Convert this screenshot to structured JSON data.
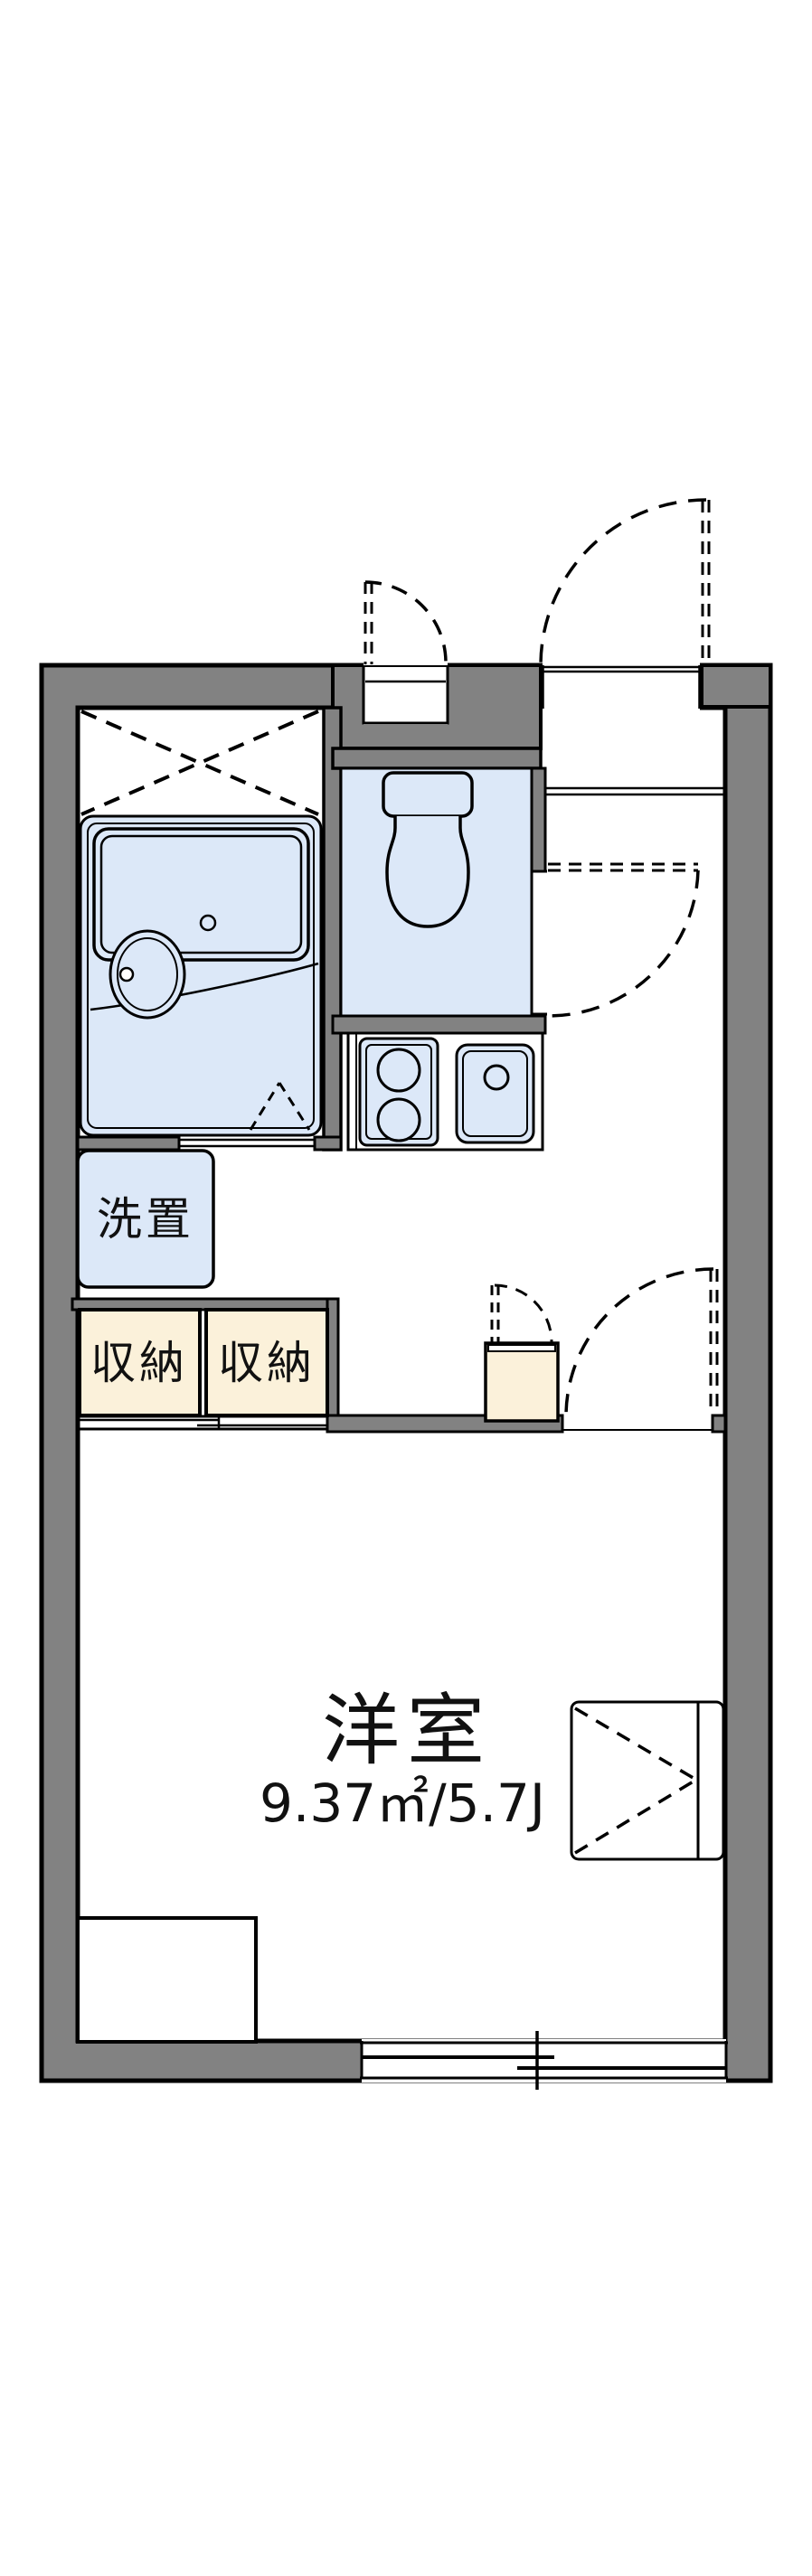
{
  "plan": {
    "type": "apartment-floorplan",
    "labels": {
      "washer_space": "洗置",
      "storage_left": "収納",
      "storage_right": "収納",
      "main_room_name": "洋室",
      "main_room_area": "9.37㎡/5.7J"
    },
    "rooms": {
      "main_room": {
        "name": "洋室",
        "area_m2": "9.37",
        "area_tatami": "5.7J"
      },
      "washer_space": {
        "name": "洗置"
      },
      "storage_count": 2
    },
    "colors": {
      "wall_fill": "#828282",
      "outline": "#000000",
      "wet_area_fill": "#dce8f8",
      "storage_fill": "#fbf1da",
      "floor_fill": "#ffffff"
    }
  }
}
